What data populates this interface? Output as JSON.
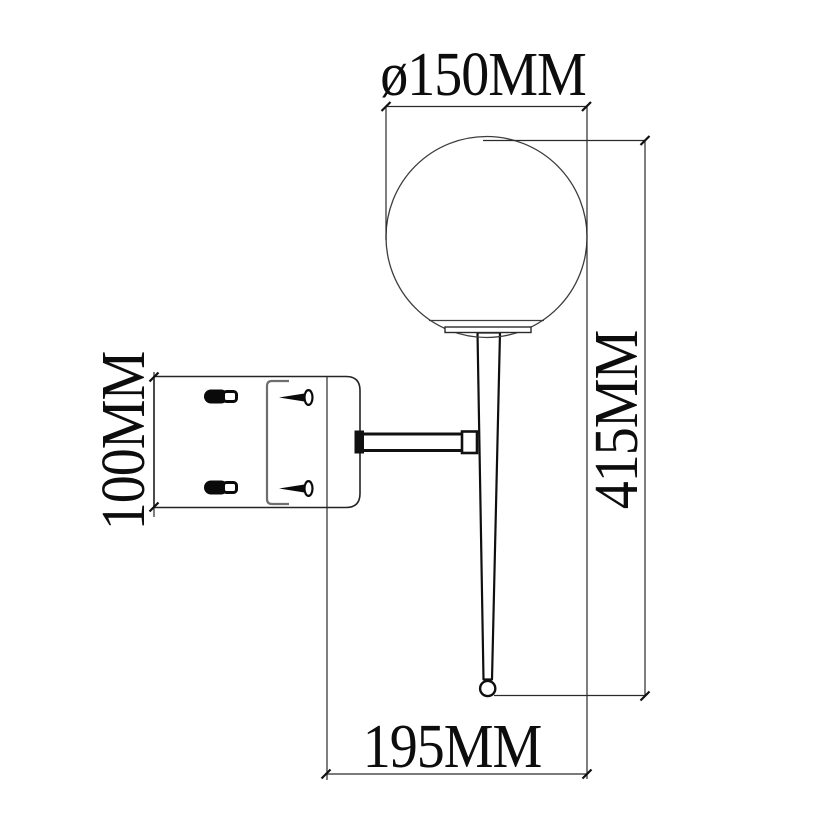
{
  "drawing": {
    "kind": "technical-dimension-drawing",
    "subject": "wall sconce lamp with spherical globe shade, tapered spike body and wall mount bracket, side view",
    "background_color": "#ffffff",
    "line_color": "#1a1a1a"
  },
  "dims": {
    "diameter": {
      "label": "ø150MM",
      "value_mm": 150,
      "placement": "top-horizontal"
    },
    "height": {
      "label": "415MM",
      "value_mm": 415,
      "placement": "right-vertical"
    },
    "depth": {
      "label": "195MM",
      "value_mm": 195,
      "placement": "bottom-horizontal"
    },
    "plate": {
      "label": "100MM",
      "value_mm": 100,
      "placement": "left-vertical"
    }
  }
}
